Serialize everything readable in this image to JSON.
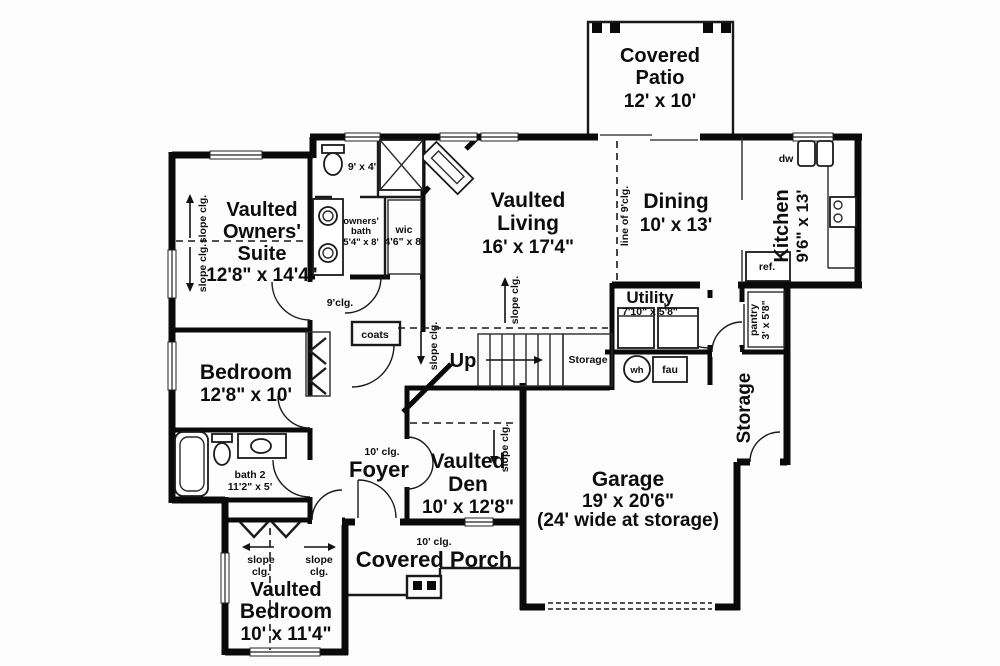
{
  "plan": {
    "patio": {
      "l1": "Covered",
      "l2": "Patio",
      "dims": "12' x 10'"
    },
    "living": {
      "l1": "Vaulted",
      "l2": "Living",
      "dims": "16' x 17'4\""
    },
    "dining": {
      "name": "Dining",
      "dims": "10' x 13'"
    },
    "kitchen": {
      "name": "Kitchen",
      "dims": "9'6\" x 13'"
    },
    "suite": {
      "l1": "Vaulted",
      "l2": "Owners'",
      "l3": "Suite",
      "dims": "12'8\" x 14'4\""
    },
    "bedroom2": {
      "name": "Bedroom",
      "dims": "12'8\" x 10'"
    },
    "bedroom3": {
      "l1": "Vaulted",
      "l2": "Bedroom",
      "dims": "10' x 11'4\""
    },
    "den": {
      "l1": "Vaulted",
      "l2": "Den",
      "dims": "10' x 12'8\""
    },
    "foyer": {
      "name": "Foyer",
      "clg": "10' clg."
    },
    "porch": {
      "name": "Covered Porch",
      "clg": "10' clg."
    },
    "garage": {
      "name": "Garage",
      "dims": "19' x 20'6\"",
      "note": "(24' wide at storage)"
    },
    "utility": {
      "name": "Utility",
      "dims": "7'10\" x 5'8\""
    },
    "pantry": {
      "name": "pantry",
      "dims": "3' x 5'8\""
    },
    "storage_garage": "Storage",
    "storage_stairs": "Storage",
    "owners_bath": {
      "l1": "owners'",
      "l2": "bath",
      "dims": "5'4\" x 8'"
    },
    "bath2": {
      "name": "bath 2",
      "dims": "11'2\" x 5'"
    },
    "wic": {
      "name": "wic",
      "dims": "4'6\" x 8'"
    },
    "toilet_room_dims": "9' x 4'",
    "coats": "coats",
    "up": "Up",
    "labels": {
      "slope": "slope clg.",
      "slope_a": "slope",
      "slope_b": "clg.",
      "clg9": "9'clg.",
      "line9": "line of 9'clg.",
      "wh": "wh",
      "fau": "fau",
      "ref": "ref.",
      "dw": "dw"
    }
  }
}
